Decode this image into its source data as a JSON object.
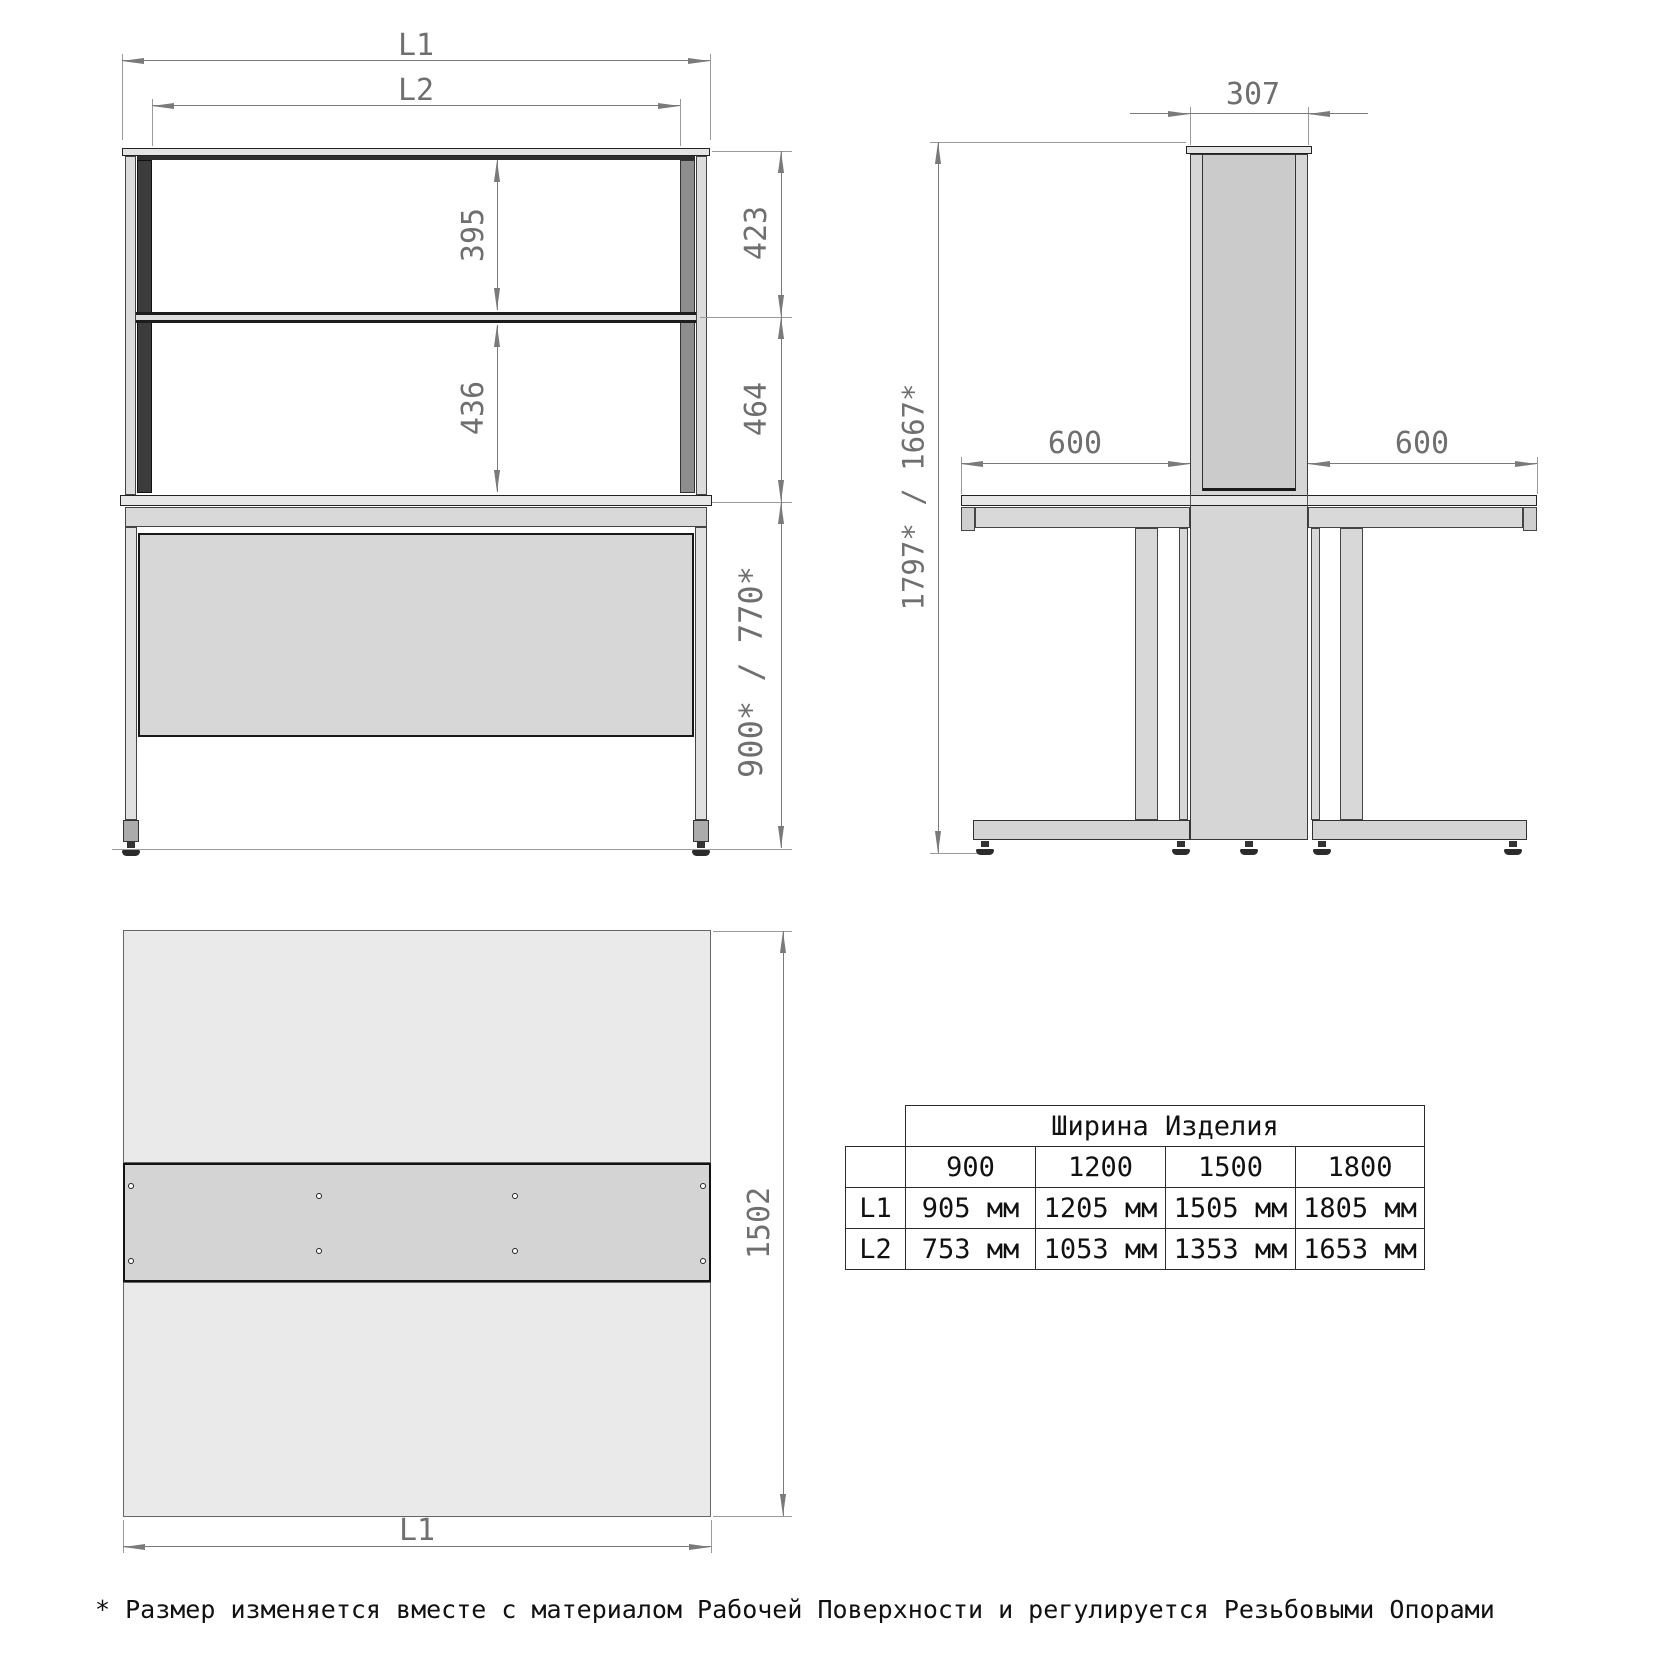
{
  "front_view": {
    "dim_l1": "L1",
    "dim_l2": "L2",
    "dim_shelf_upper": "395",
    "dim_shelf_lower": "436",
    "dim_right_upper": "423",
    "dim_right_lower": "464",
    "dim_table_height": "900* / 770*"
  },
  "side_view": {
    "dim_depth": "307",
    "dim_height": "1797* / 1667*",
    "dim_left_top": "600",
    "dim_right_top": "600"
  },
  "top_view": {
    "dim_depth": "1502",
    "dim_width": "L1"
  },
  "size_table": {
    "title": "Ширина Изделия",
    "col_headers": [
      "900",
      "1200",
      "1500",
      "1800"
    ],
    "rows": [
      {
        "label": "L1",
        "values": [
          "905 мм",
          "1205 мм",
          "1505 мм",
          "1805 мм"
        ]
      },
      {
        "label": "L2",
        "values": [
          "753 мм",
          "1053 мм",
          "1353 мм",
          "1653 мм"
        ]
      }
    ]
  },
  "footnote": "* Размер изменяется вместе с материалом Рабочей Поверхности и регулируется Резьбовыми Опорами",
  "colors": {
    "dimension_text": "#6f6f6f",
    "outline": "#1a1a1a",
    "fill_light": "#e8e8e8",
    "fill_mid": "#d6d6d6",
    "dark_column": "#3c3c3c"
  }
}
